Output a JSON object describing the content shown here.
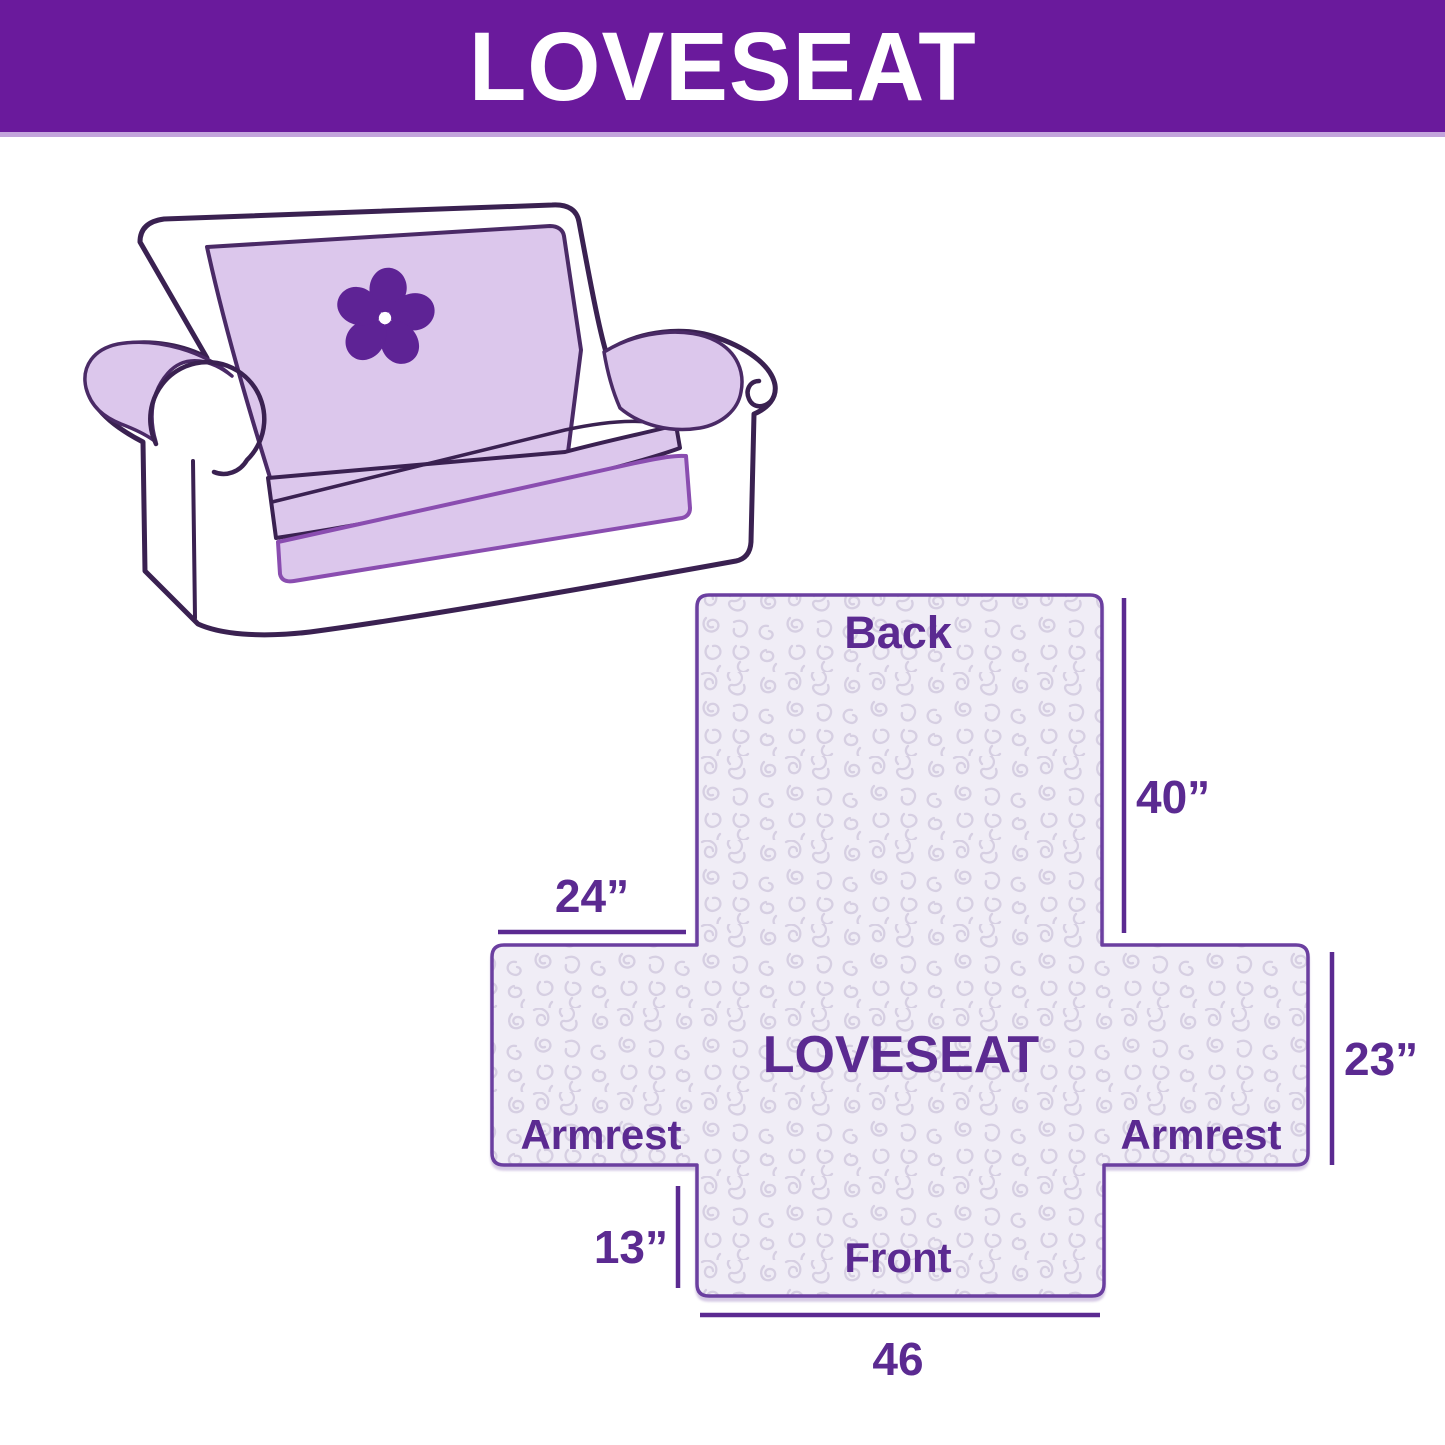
{
  "header": {
    "title": "LOVESEAT",
    "background_color": "#6A1A9C",
    "text_color": "#FFFFFF"
  },
  "illustration": {
    "description": "Line drawing of a loveseat sofa with a lavender protective cover draped over the back, seat and armrests",
    "logo_icon": "pinwheel-flower-icon",
    "cover_color": "#DCC7EC",
    "outline_color": "#3A2151",
    "logo_color": "#5E2395"
  },
  "diagram": {
    "shape": "loveseat cover flat layout (cross shape)",
    "fill_color": "#F0EDF6",
    "pattern_color": "#D6CFE2",
    "outline_color": "#6B3FA0",
    "label_color": "#5B2A91",
    "labels": {
      "back": "Back",
      "center": "LOVESEAT",
      "armrest_left": "Armrest",
      "armrest_right": "Armrest",
      "front": "Front"
    },
    "dimensions": {
      "back_height": "40”",
      "armrest_width": "24”",
      "seat_depth": "23”",
      "front_drop": "13”",
      "front_width": "46"
    }
  }
}
